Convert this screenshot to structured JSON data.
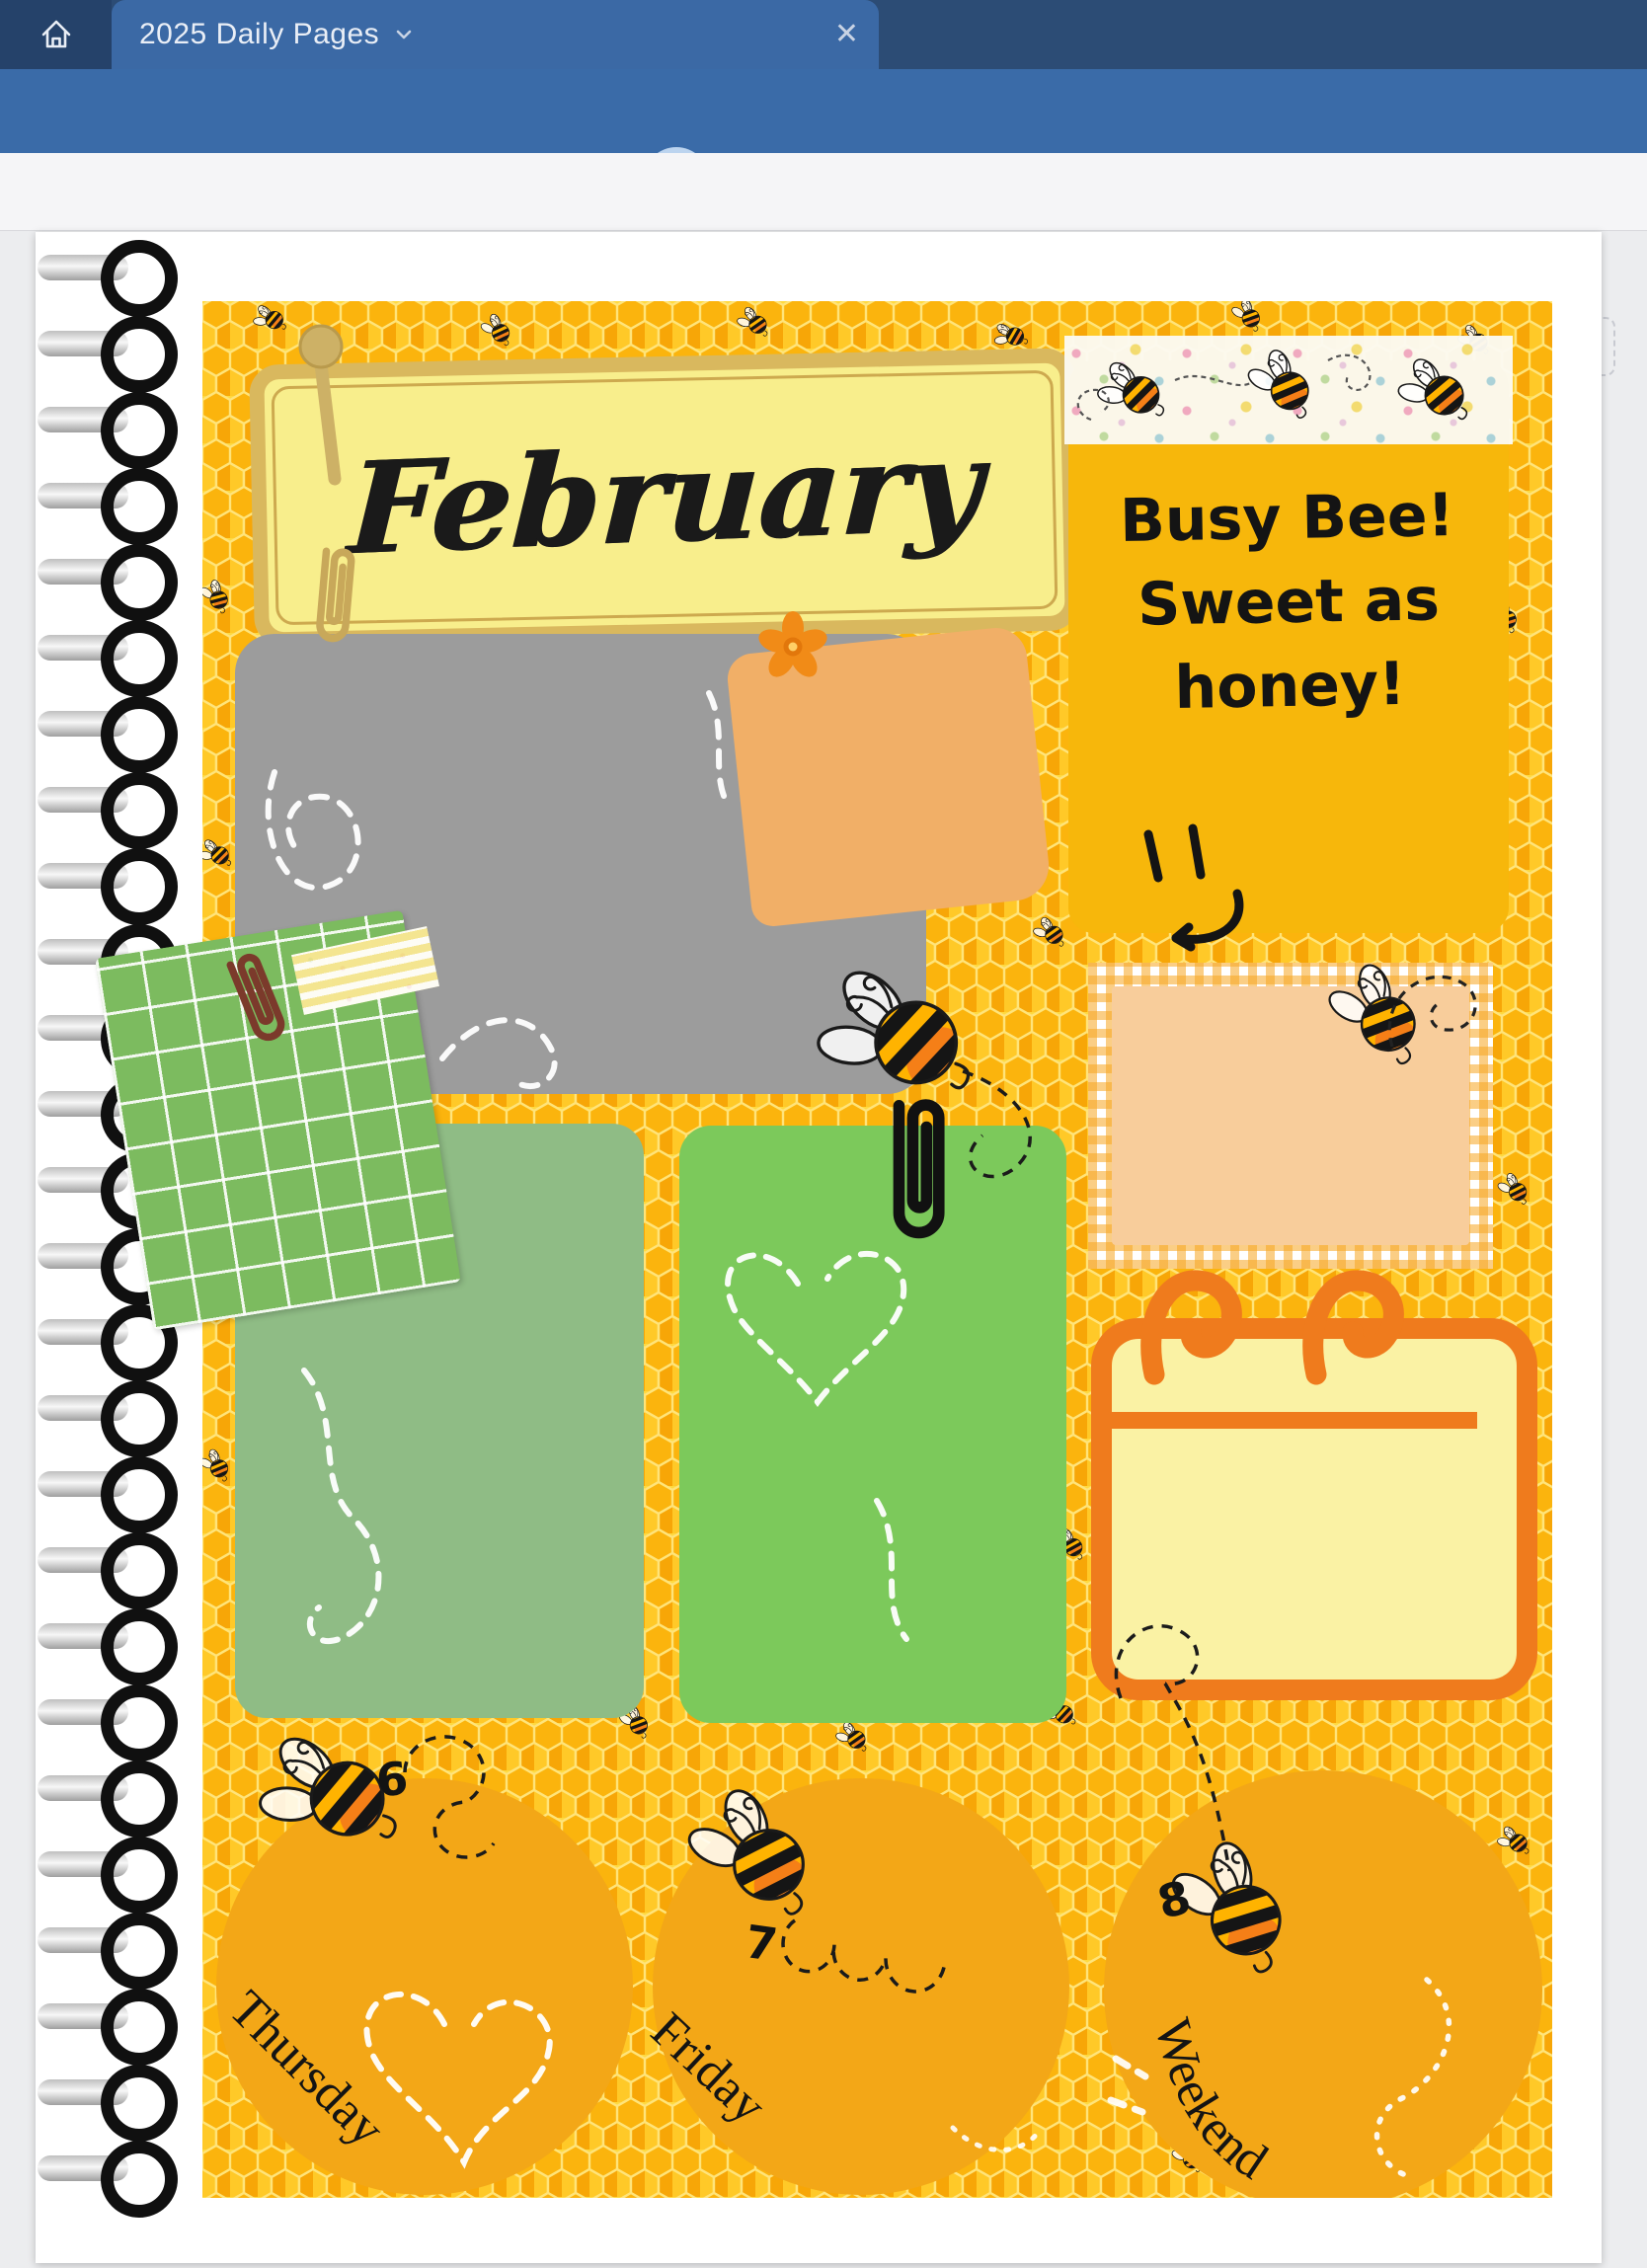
{
  "tab_bar": {
    "title": "2025 Daily Pages",
    "close_glyph": "✕"
  },
  "top_toolbar": {
    "left_icons": [
      "apps-grid",
      "search",
      "ai-assistant"
    ],
    "center_icons": [
      "pen-active",
      "keyboard",
      "microphone-muted"
    ],
    "right_icons": [
      "add-page",
      "bookmark",
      "share",
      "more-options"
    ]
  },
  "tools_toolbar": {
    "icons": [
      "undo",
      "redo",
      "pen",
      "pencil",
      "eraser",
      "highlighter",
      "tape",
      "shapes",
      "lasso",
      "sticker",
      "sticky-note",
      "image",
      "cut-lasso",
      "select-rectangle"
    ],
    "active_tool": "lasso",
    "text_preview": "abc ~~~~~"
  },
  "notebook": {
    "ring_count": 26
  },
  "page": {
    "month_title": "February",
    "sticky_note_lines": [
      "Busy Bee!",
      "Sweet as",
      "honey!"
    ],
    "day_circles": [
      {
        "label": "Thursday",
        "date": "6"
      },
      {
        "label": "Friday",
        "date": "7"
      },
      {
        "label": "Weekend",
        "date": "8"
      }
    ]
  },
  "colors": {
    "tabbar": "#2C4C75",
    "toolbar": "#3A6BA8",
    "tab": "#3B69A5",
    "honey_yellow": "#FFD733",
    "amber_note": "#F7B70B",
    "banner_frame": "#D9B85E",
    "banner_fill": "#F8EE8C",
    "gray_box": "#9C9C9C",
    "sage_box": "#8FBC85",
    "green_box": "#7CC95B",
    "grid_note": "#7CBB5F",
    "peach_note": "#F1AF67",
    "gingham_fill": "#F8CD9B",
    "calendar_orange": "#EF7B1D",
    "calendar_fill": "#FAF2A4",
    "day_circle": "#F3A717",
    "active_tool_blue": "#2F6FD0"
  },
  "decor": {
    "scatter_bees": [
      [
        70,
        18,
        -15
      ],
      [
        300,
        30,
        10
      ],
      [
        560,
        22,
        0
      ],
      [
        820,
        35,
        -25
      ],
      [
        1060,
        15,
        15
      ],
      [
        1290,
        40,
        0
      ],
      [
        15,
        300,
        20
      ],
      [
        15,
        560,
        -10
      ],
      [
        20,
        840,
        5
      ],
      [
        860,
        640,
        0
      ],
      [
        858,
        955,
        -18
      ],
      [
        15,
        1180,
        12
      ],
      [
        140,
        1420,
        -8
      ],
      [
        440,
        1440,
        14
      ],
      [
        870,
        1430,
        -12
      ],
      [
        1330,
        900,
        8
      ],
      [
        1335,
        1180,
        -14
      ],
      [
        1320,
        320,
        18
      ],
      [
        660,
        1455,
        0
      ],
      [
        200,
        1870,
        10
      ],
      [
        600,
        1880,
        -12
      ],
      [
        1000,
        1880,
        8
      ],
      [
        1330,
        1560,
        -6
      ],
      [
        880,
        1260,
        6
      ],
      [
        430,
        620,
        -20
      ],
      [
        1190,
        120,
        -10
      ]
    ]
  }
}
